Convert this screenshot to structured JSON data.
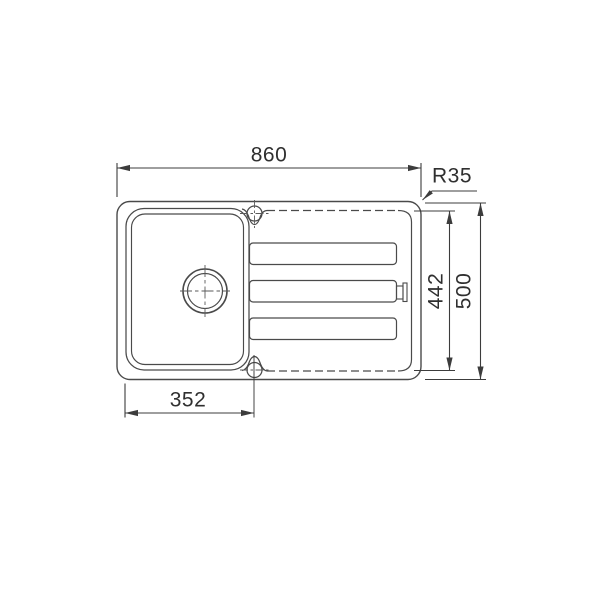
{
  "drawing": {
    "type": "technical dimension drawing",
    "view": "sink top view, single bowl with drainer",
    "labels": {
      "overall_width": "860",
      "corner_radius": "R35",
      "inner_depth": "442",
      "overall_depth": "500",
      "bowl_width": "352"
    },
    "colors": {
      "line": "#4a4a4a",
      "dimension": "#3c3c3c",
      "text": "#2f2f2f",
      "background": "#ffffff"
    }
  }
}
